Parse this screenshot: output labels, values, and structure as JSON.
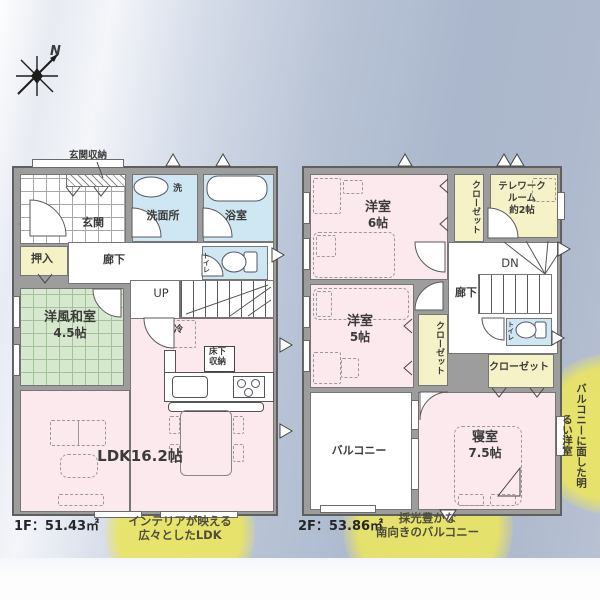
{
  "compass": {
    "label": "N"
  },
  "f1": {
    "area": "1F：51.43㎡",
    "genkan_storage": "玄関収納",
    "genkan": "玄関",
    "washer": "洗",
    "washroom": "洗面所",
    "bath": "浴室",
    "oshiire": "押入",
    "hall": "廊下",
    "toilet": "トイレ",
    "stairs": "UP",
    "tatami_name": "洋風和室",
    "tatami_size": "4.5帖",
    "fridge": "冷",
    "underfloor1": "床下",
    "underfloor2": "収納",
    "ldk": "LDK16.2帖",
    "callout1": "インテリアが映える",
    "callout2": "広々としたLDK"
  },
  "f2": {
    "area": "2F：53.86㎡",
    "room6_name": "洋室",
    "room6_size": "6帖",
    "closet_n": "クローゼット",
    "closet_e": "クローゼット",
    "closet_s": "クローゼット",
    "telework1": "テレワーク",
    "telework2": "ルーム",
    "telework3": "約2帖",
    "stairs": "DN",
    "hall": "廊下",
    "room5_name": "洋室",
    "room5_size": "5帖",
    "toilet": "トイレ",
    "balcony": "バルコニー",
    "master_name": "寝室",
    "master_size": "7.5帖",
    "callout1": "採光豊かな",
    "callout2": "南向きのバルコニー",
    "side_note": "バルコニーに面した明るい洋室"
  },
  "colors": {
    "room_pink": "#fbe9ee",
    "room_blue": "#cfe7f2",
    "room_green": "#d6e9cf",
    "room_yellow": "#f6f2c8",
    "wall_gray": "#9d9d9d",
    "highlight_yellow": "#e9e464"
  }
}
